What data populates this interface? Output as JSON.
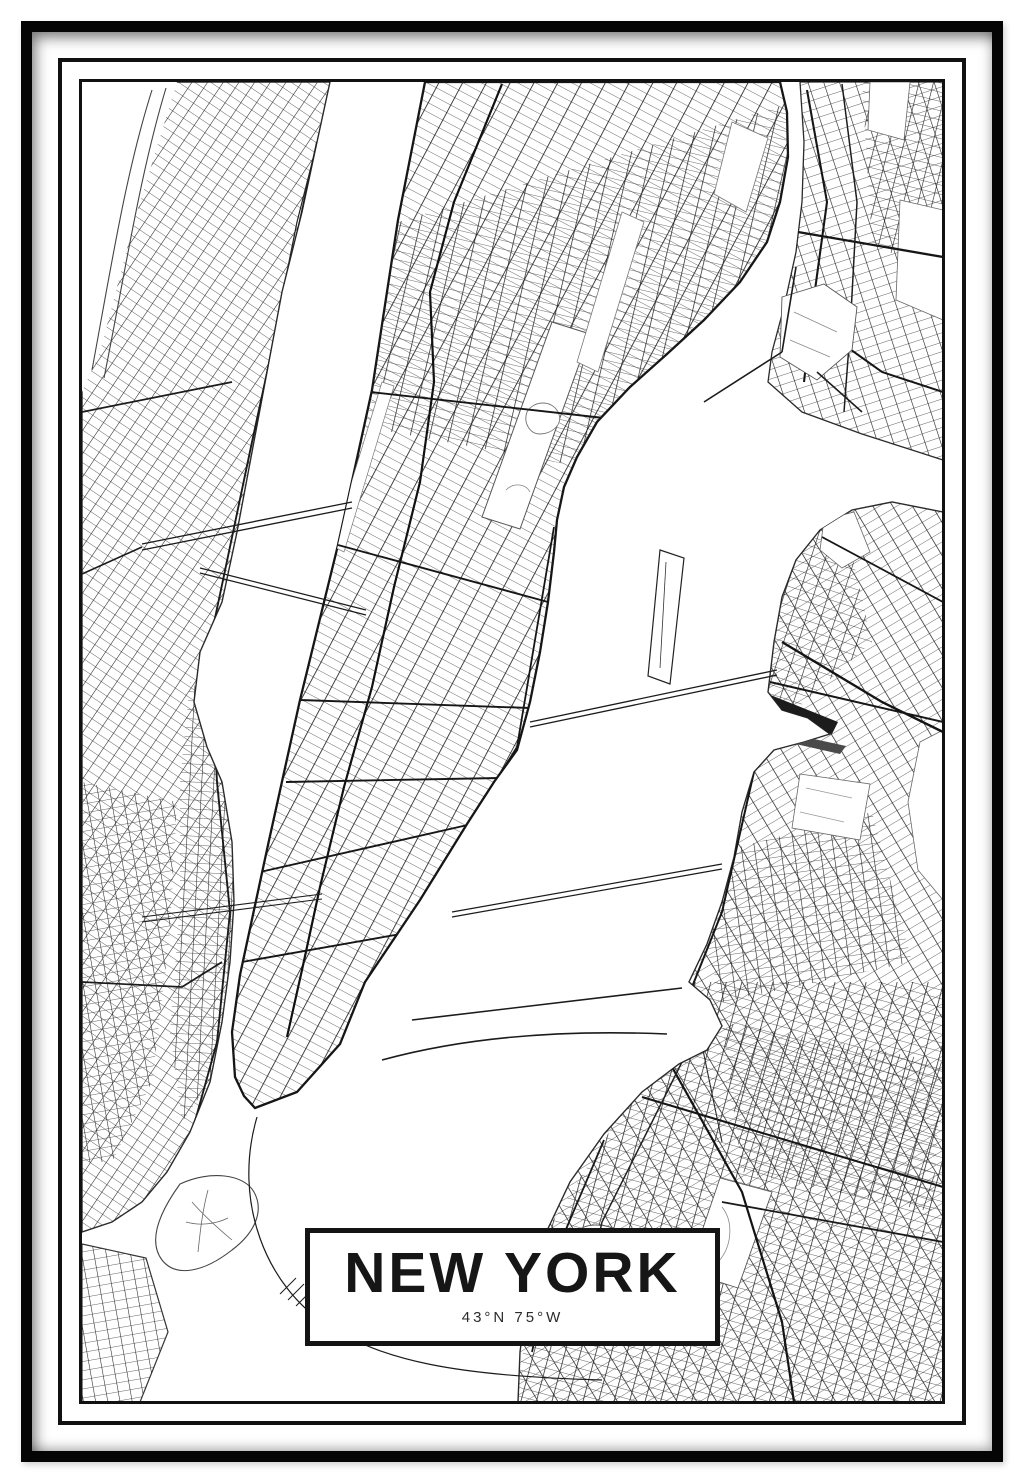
{
  "poster": {
    "title": "NEW YORK",
    "coordinates": "43°N 75°W",
    "ink_color": "#1b1b1b",
    "paper_color": "#ffffff"
  },
  "map": {
    "style": "black-and-white street map",
    "features": [
      "manhattan",
      "new-jersey",
      "bronx",
      "queens",
      "brooklyn",
      "hudson-river",
      "east-river",
      "harlem-river",
      "central-park",
      "roosevelt-island",
      "randalls-island",
      "governors-island",
      "prospect-park",
      "bridges"
    ]
  }
}
